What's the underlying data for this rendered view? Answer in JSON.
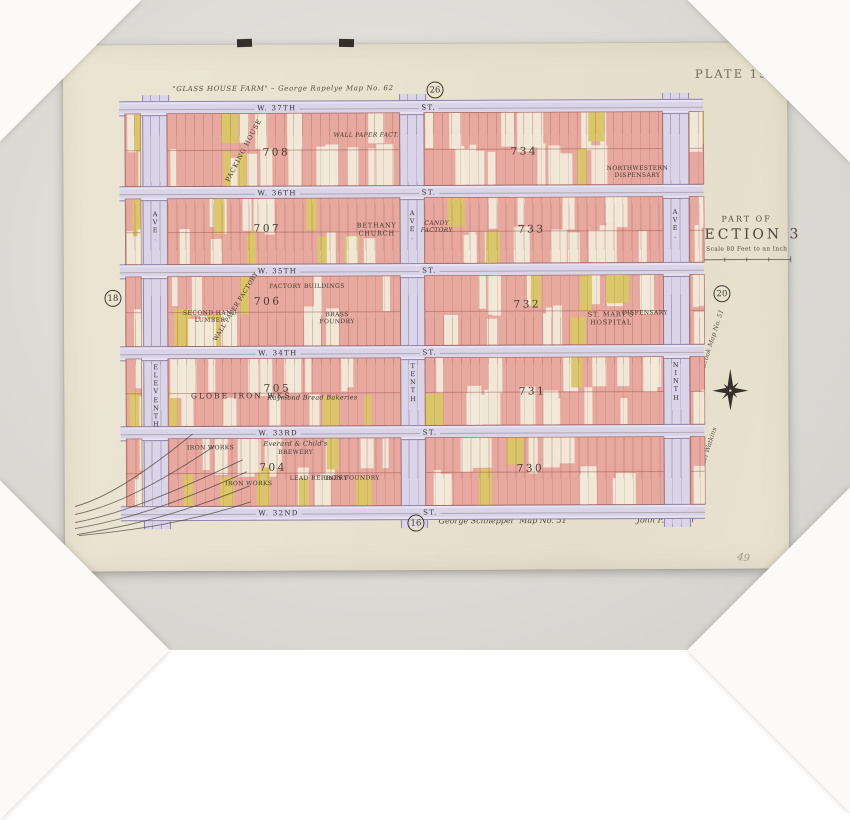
{
  "plate_title": "PLATE 19.",
  "section": {
    "part_of": "PART OF",
    "name": "SECTION 3",
    "scale": "Scale 80 Feet to an Inch"
  },
  "margin_notes": {
    "top": "\"GLASS HOUSE FARM\" – George Rapelye   Map No. 62",
    "bottom_surveyor": "George Schneppel",
    "bottom_map_no": "Map No. 51",
    "bottom_right": "John P. Bowler",
    "side_upper": "Lease Brook   Map No. 51",
    "side_lower": "Samuel Watkins",
    "pencil": "49"
  },
  "plate_refs": [
    {
      "num": "26",
      "x": 372,
      "y": 46
    },
    {
      "num": "18",
      "x": 49,
      "y": 253
    },
    {
      "num": "20",
      "x": 658,
      "y": 251
    },
    {
      "num": "16",
      "x": 351,
      "y": 479
    }
  ],
  "streets": [
    {
      "name": "W. 37TH",
      "suffix": "ST."
    },
    {
      "name": "W. 36TH",
      "suffix": "ST."
    },
    {
      "name": "W. 35TH",
      "suffix": "ST."
    },
    {
      "name": "W. 34TH",
      "suffix": "ST."
    },
    {
      "name": "W. 33RD",
      "suffix": "ST."
    },
    {
      "name": "W. 32ND",
      "suffix": "ST."
    }
  ],
  "avenues": [
    {
      "name": "ELEVENTH",
      "suffix": "AVE."
    },
    {
      "name": "TENTH",
      "suffix": "AVE."
    },
    {
      "name": "NINTH",
      "suffix": "AVE."
    }
  ],
  "blocks": [
    {
      "number": "708",
      "row": 0,
      "col": 0,
      "nx": 47,
      "ny": 54
    },
    {
      "number": "734",
      "row": 0,
      "col": 1,
      "nx": 42,
      "ny": 54
    },
    {
      "number": "707",
      "row": 1,
      "col": 0,
      "nx": 43,
      "ny": 46
    },
    {
      "number": "733",
      "row": 1,
      "col": 1,
      "nx": 45,
      "ny": 49
    },
    {
      "number": "706",
      "row": 2,
      "col": 0,
      "nx": 43,
      "ny": 36
    },
    {
      "number": "732",
      "row": 2,
      "col": 1,
      "nx": 43,
      "ny": 42
    },
    {
      "number": "705",
      "row": 3,
      "col": 0,
      "nx": 47,
      "ny": 45
    },
    {
      "number": "731",
      "row": 3,
      "col": 1,
      "nx": 45,
      "ny": 51
    },
    {
      "number": "704",
      "row": 4,
      "col": 0,
      "nx": 45,
      "ny": 43
    },
    {
      "number": "730",
      "row": 4,
      "col": 1,
      "nx": 44,
      "ny": 46
    }
  ],
  "labels": [
    {
      "t": "PACKING HOUSE",
      "x": 181,
      "y": 106,
      "r": -62,
      "s": "capsm"
    },
    {
      "t": "WALL PAPER FACT.",
      "x": 303,
      "y": 91,
      "s": "tinyi"
    },
    {
      "t": "NORTHWESTERN\nDISPENSARY",
      "x": 574,
      "y": 129,
      "s": "tiny"
    },
    {
      "t": "BETHANY\nCHURCH",
      "x": 313,
      "y": 186,
      "s": "capsm"
    },
    {
      "t": "CANDY\nFACTORY",
      "x": 373,
      "y": 183,
      "s": "tinyi"
    },
    {
      "t": "FACTORY BUILDINGS",
      "x": 243,
      "y": 242,
      "s": "tiny"
    },
    {
      "t": "WALL PAPER FACTORY",
      "x": 172,
      "y": 262,
      "r": -58,
      "s": "tiny"
    },
    {
      "t": "SECOND HAND\nLUMBER",
      "x": 146,
      "y": 272,
      "s": "tiny"
    },
    {
      "t": "BRASS\nFOUNDRY",
      "x": 273,
      "y": 274,
      "s": "tiny"
    },
    {
      "t": "ST. MARY'S\nHOSPITAL",
      "x": 547,
      "y": 276,
      "s": "capsm"
    },
    {
      "t": "DISPENSARY",
      "x": 581,
      "y": 270,
      "s": "tiny"
    },
    {
      "t": "GLOBE IRON WKS.",
      "x": 179,
      "y": 351,
      "s": "capmed"
    },
    {
      "t": "Raymond Bread Bakeries",
      "x": 248,
      "y": 354,
      "s": "script"
    },
    {
      "t": "IRON WORKS",
      "x": 146,
      "y": 403,
      "s": "tiny"
    },
    {
      "t": "Everard & Child's",
      "x": 231,
      "y": 400,
      "s": "script"
    },
    {
      "t": "BREWERY",
      "x": 231,
      "y": 408,
      "s": "tiny"
    },
    {
      "t": "IRON WORKS",
      "x": 184,
      "y": 439,
      "s": "tiny"
    },
    {
      "t": "LEAD REFINERY",
      "x": 254,
      "y": 434,
      "s": "tiny"
    },
    {
      "t": "IRON FOUNDRY",
      "x": 287,
      "y": 434,
      "s": "tiny"
    }
  ]
}
